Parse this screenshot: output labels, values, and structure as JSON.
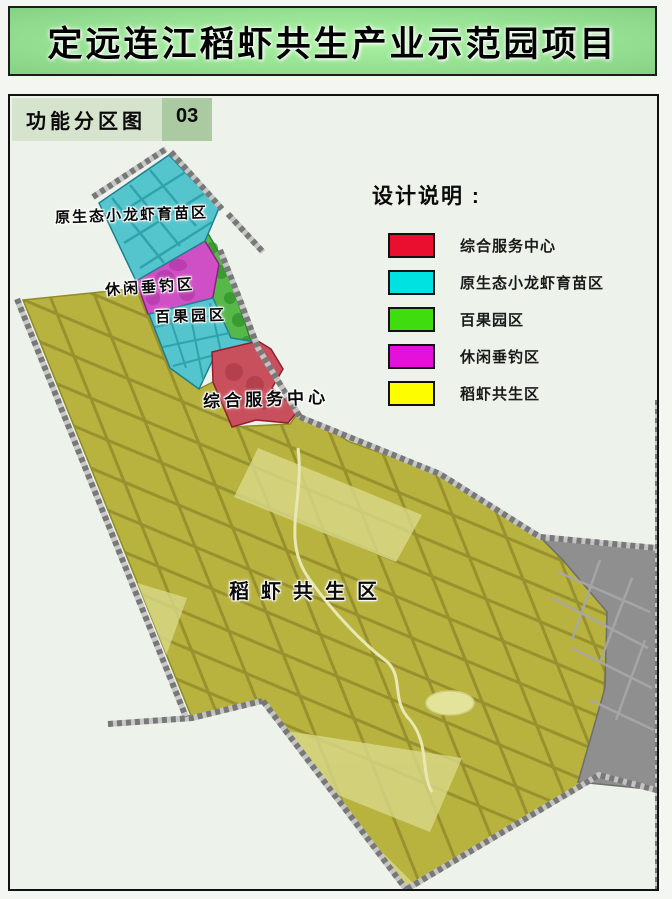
{
  "page": {
    "title": "定远连江稻虾共生产业示范园项目",
    "map_type_label": "功能分区图",
    "map_number": "03"
  },
  "legend": {
    "title": "设计说明 :",
    "items": [
      {
        "label": "综合服务中心",
        "color": "#ea0f2f"
      },
      {
        "label": "原生态小龙虾育苗区",
        "color": "#00e1e1"
      },
      {
        "label": "百果园区",
        "color": "#3fdc0e"
      },
      {
        "label": "休闲垂钓区",
        "color": "#e411dc"
      },
      {
        "label": "稻虾共生区",
        "color": "#fdfd00"
      }
    ]
  },
  "map": {
    "labels": {
      "nursery": "原生态小龙虾育苗区",
      "fishing": "休闲垂钓区",
      "orchard": "百果园区",
      "service": "综合服务中心",
      "rice": "稻虾共生区"
    },
    "zones": {
      "rice_shrimp": {
        "name": "稻虾共生区",
        "color": "#b8b23f"
      },
      "crayfish_nursery": {
        "name": "原生态小龙虾育苗区",
        "color": "#55c5cd"
      },
      "orchard": {
        "name": "百果园区",
        "color": "#57b84a"
      },
      "fishing": {
        "name": "休闲垂钓区",
        "color": "#cf4fc4"
      },
      "service_center": {
        "name": "综合服务中心",
        "color": "#c8505c"
      },
      "existing_area": {
        "name": "",
        "color": "#8f8f8f"
      }
    }
  }
}
